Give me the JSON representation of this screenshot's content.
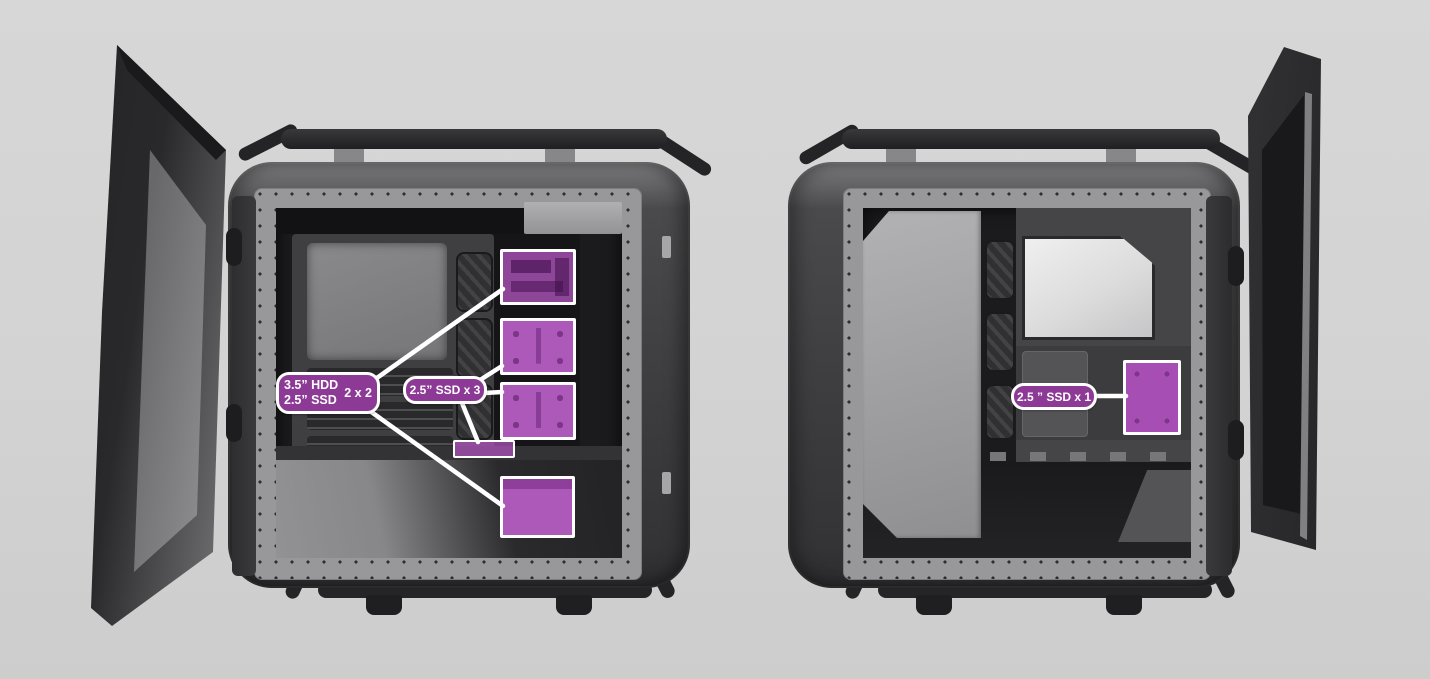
{
  "scene": {
    "background": "#d2d2d2",
    "subject": "PC case interior drive-bay locations, two open-door side views"
  },
  "palette": {
    "highlight_fill": "#ad59ba",
    "highlight_fill_translucent": "rgba(173,83,186,0.8)",
    "label_fill": "#8d3a96",
    "callout_border": "#ffffff",
    "case_dark": "#3a3a3c",
    "frame_light": "#98989a"
  },
  "left_view": {
    "callouts": {
      "hdd_ssd_combo": {
        "line1": "3.5” HDD",
        "line2": "2.5” SSD",
        "count": "2 x 2"
      },
      "ssd_x3": {
        "text": "2.5” SSD x 3"
      }
    },
    "highlights": [
      {
        "name": "hdd-cage"
      },
      {
        "name": "ssd-tray-upper"
      },
      {
        "name": "ssd-tray-lower"
      },
      {
        "name": "ssd-bracket-slim"
      },
      {
        "name": "shroud-mount"
      }
    ]
  },
  "right_view": {
    "callouts": {
      "ssd_x1": {
        "text": "2.5 ” SSD x 1"
      }
    },
    "highlights": [
      {
        "name": "ssd-mount-rear"
      }
    ]
  }
}
